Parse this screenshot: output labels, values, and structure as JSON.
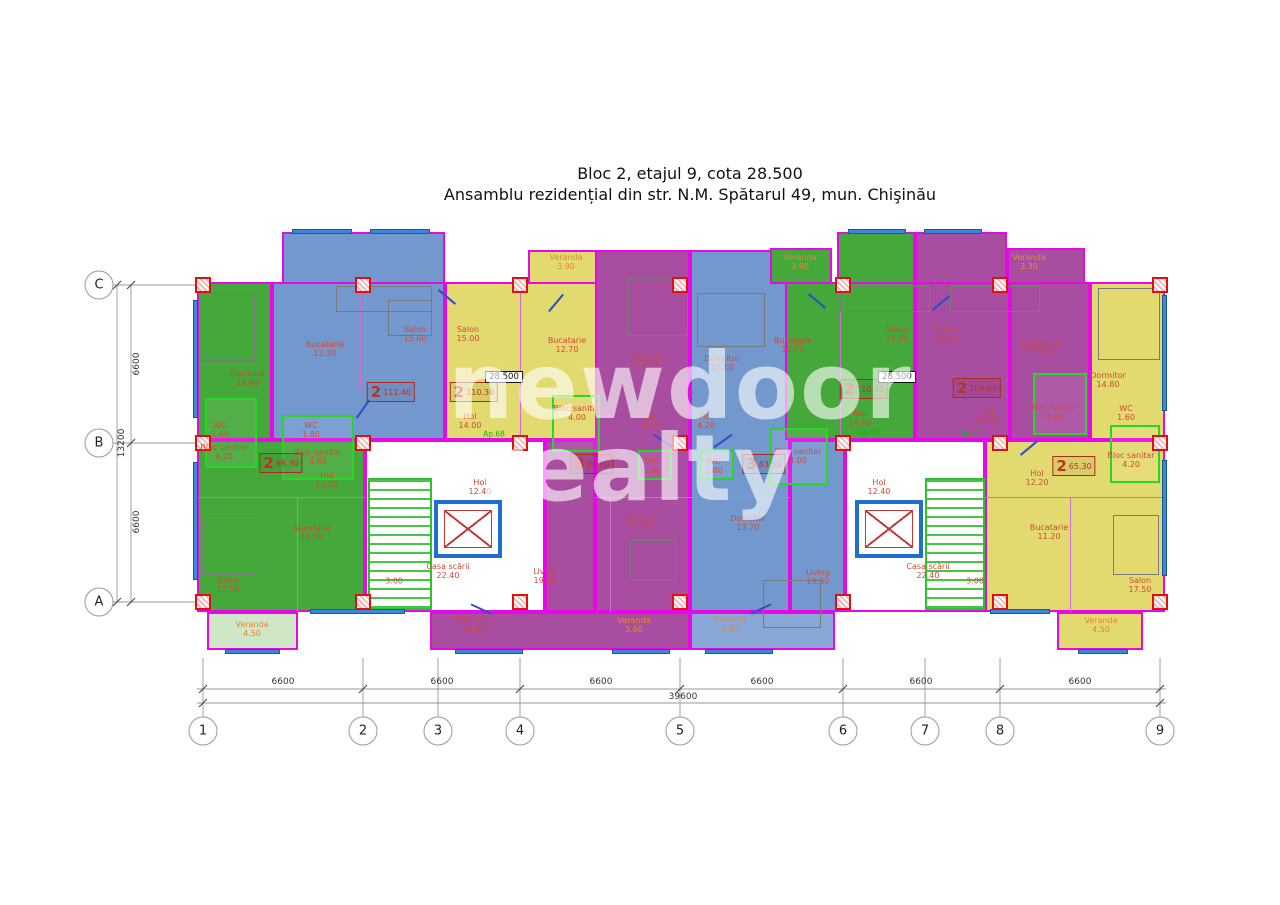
{
  "title": {
    "line1": "Bloc 2, etajul 9, cota 28.500",
    "line2": "Ansamblu rezidențial din str. N.M. Spătarul 49, mun. Chişinău"
  },
  "watermark": {
    "line1": "newdoor",
    "line2": "realty"
  },
  "level_mark": "28.500",
  "grid": {
    "cols": [
      "1",
      "2",
      "3",
      "4",
      "5",
      "6",
      "7",
      "8",
      "9"
    ],
    "rows": [
      "C",
      "B",
      "A"
    ]
  },
  "dimensions": {
    "horizontal": [
      "6600",
      "6600",
      "6600",
      "6600",
      "6600",
      "6600"
    ],
    "total_width": "39600",
    "vertical": [
      "6600",
      "6600"
    ],
    "total_height": "13200"
  },
  "apartments": {
    "green_left": {
      "badge_num": "2",
      "badge_area": "66.30",
      "rooms": [
        {
          "name": "Dormitor",
          "area": "14.80"
        },
        {
          "name": "WC",
          "area": "1.60"
        },
        {
          "name": "Bloc sanitar",
          "area": "4.20"
        },
        {
          "name": "Hol",
          "area": "12.20"
        },
        {
          "name": "Bucatarie",
          "area": "11.20"
        },
        {
          "name": "Salon",
          "area": "17.50"
        },
        {
          "name": "Veranda",
          "area": "4.50"
        }
      ]
    },
    "blue_left": {
      "badge_num": "2",
      "badge_area": "111.40",
      "rooms": [
        {
          "name": "Bucatarie",
          "area": "12.30"
        },
        {
          "name": "Salon",
          "area": "15.60"
        },
        {
          "name": "WC",
          "area": "1.80"
        },
        {
          "name": "Bloc sanitar",
          "area": "4.60"
        }
      ]
    },
    "yellow_left": {
      "badge_num": "2",
      "badge_area": "110.30",
      "ap_no": "Ap.68",
      "rooms": [
        {
          "name": "Veranda",
          "area": "3.90"
        },
        {
          "name": "Salon",
          "area": "15.00"
        },
        {
          "name": "Bucatarie",
          "area": "12.70"
        },
        {
          "name": "Bloc sanitar",
          "area": "4.00"
        },
        {
          "name": "Hol",
          "area": "14.00"
        }
      ]
    },
    "purple_center": {
      "badge_num": "3",
      "badge_area": "84.80",
      "rooms": [
        {
          "name": "Dormitor",
          "area": "17.10"
        },
        {
          "name": "Hol",
          "area": "4.20"
        },
        {
          "name": "WC",
          "area": "1.80"
        },
        {
          "name": "Dormitor",
          "area": "13.70"
        },
        {
          "name": "Living",
          "area": "19.90"
        },
        {
          "name": "Bucatarie",
          "area": "11.90"
        },
        {
          "name": "Veranda",
          "area": "3.60"
        }
      ]
    },
    "blue_center": {
      "badge_num": "3",
      "badge_area": "83.50",
      "rooms": [
        {
          "name": "Dormitor",
          "area": "17.10"
        },
        {
          "name": "Hol",
          "area": "4.20"
        },
        {
          "name": "WC",
          "area": "1.80"
        },
        {
          "name": "Dormitor",
          "area": "13.70"
        },
        {
          "name": "Living",
          "area": "19.90"
        },
        {
          "name": "Veranda",
          "area": "3.60"
        }
      ]
    },
    "green_right": {
      "badge_num": "2",
      "badge_area": "110.30",
      "ap_no": "Ap.69",
      "rooms": [
        {
          "name": "Veranda",
          "area": "3.90"
        },
        {
          "name": "Bucatarie",
          "area": "12.70"
        },
        {
          "name": "Salon",
          "area": "15.60"
        },
        {
          "name": "Bloc sanitar",
          "area": "4.00"
        },
        {
          "name": "Hol",
          "area": "14.00"
        }
      ]
    },
    "purple_right": {
      "badge_num": "2",
      "badge_area": "109.60",
      "ap_no": "Ap.71",
      "rooms": [
        {
          "name": "Salon",
          "area": "15.00"
        },
        {
          "name": "Veranda",
          "area": "3.30"
        },
        {
          "name": "Bucatarie",
          "area": "12.70"
        },
        {
          "name": "Bloc sanitar",
          "area": "4.00"
        },
        {
          "name": "Hol",
          "area": "12.50"
        }
      ]
    },
    "yellow_right": {
      "badge_num": "2",
      "badge_area": "65.30",
      "ap_no": "Ap.72",
      "rooms": [
        {
          "name": "Dormitor",
          "area": "14.80"
        },
        {
          "name": "WC",
          "area": "1.60"
        },
        {
          "name": "Bloc sanitar",
          "area": "4.20"
        },
        {
          "name": "Hol",
          "area": "12.20"
        },
        {
          "name": "Bucatarie",
          "area": "11.20"
        },
        {
          "name": "Salon",
          "area": "17.50"
        },
        {
          "name": "Veranda",
          "area": "4.50"
        }
      ]
    }
  },
  "stairwells": {
    "left": {
      "hall": {
        "name": "Hol",
        "area": "12.40"
      },
      "stairs": {
        "name": "Casa scării",
        "area": "22.40",
        "width": "3.00"
      }
    },
    "right": {
      "hall": {
        "name": "Hol",
        "area": "12.40"
      },
      "stairs": {
        "name": "Casa scării",
        "area": "22.40",
        "width": "3.00"
      }
    }
  }
}
